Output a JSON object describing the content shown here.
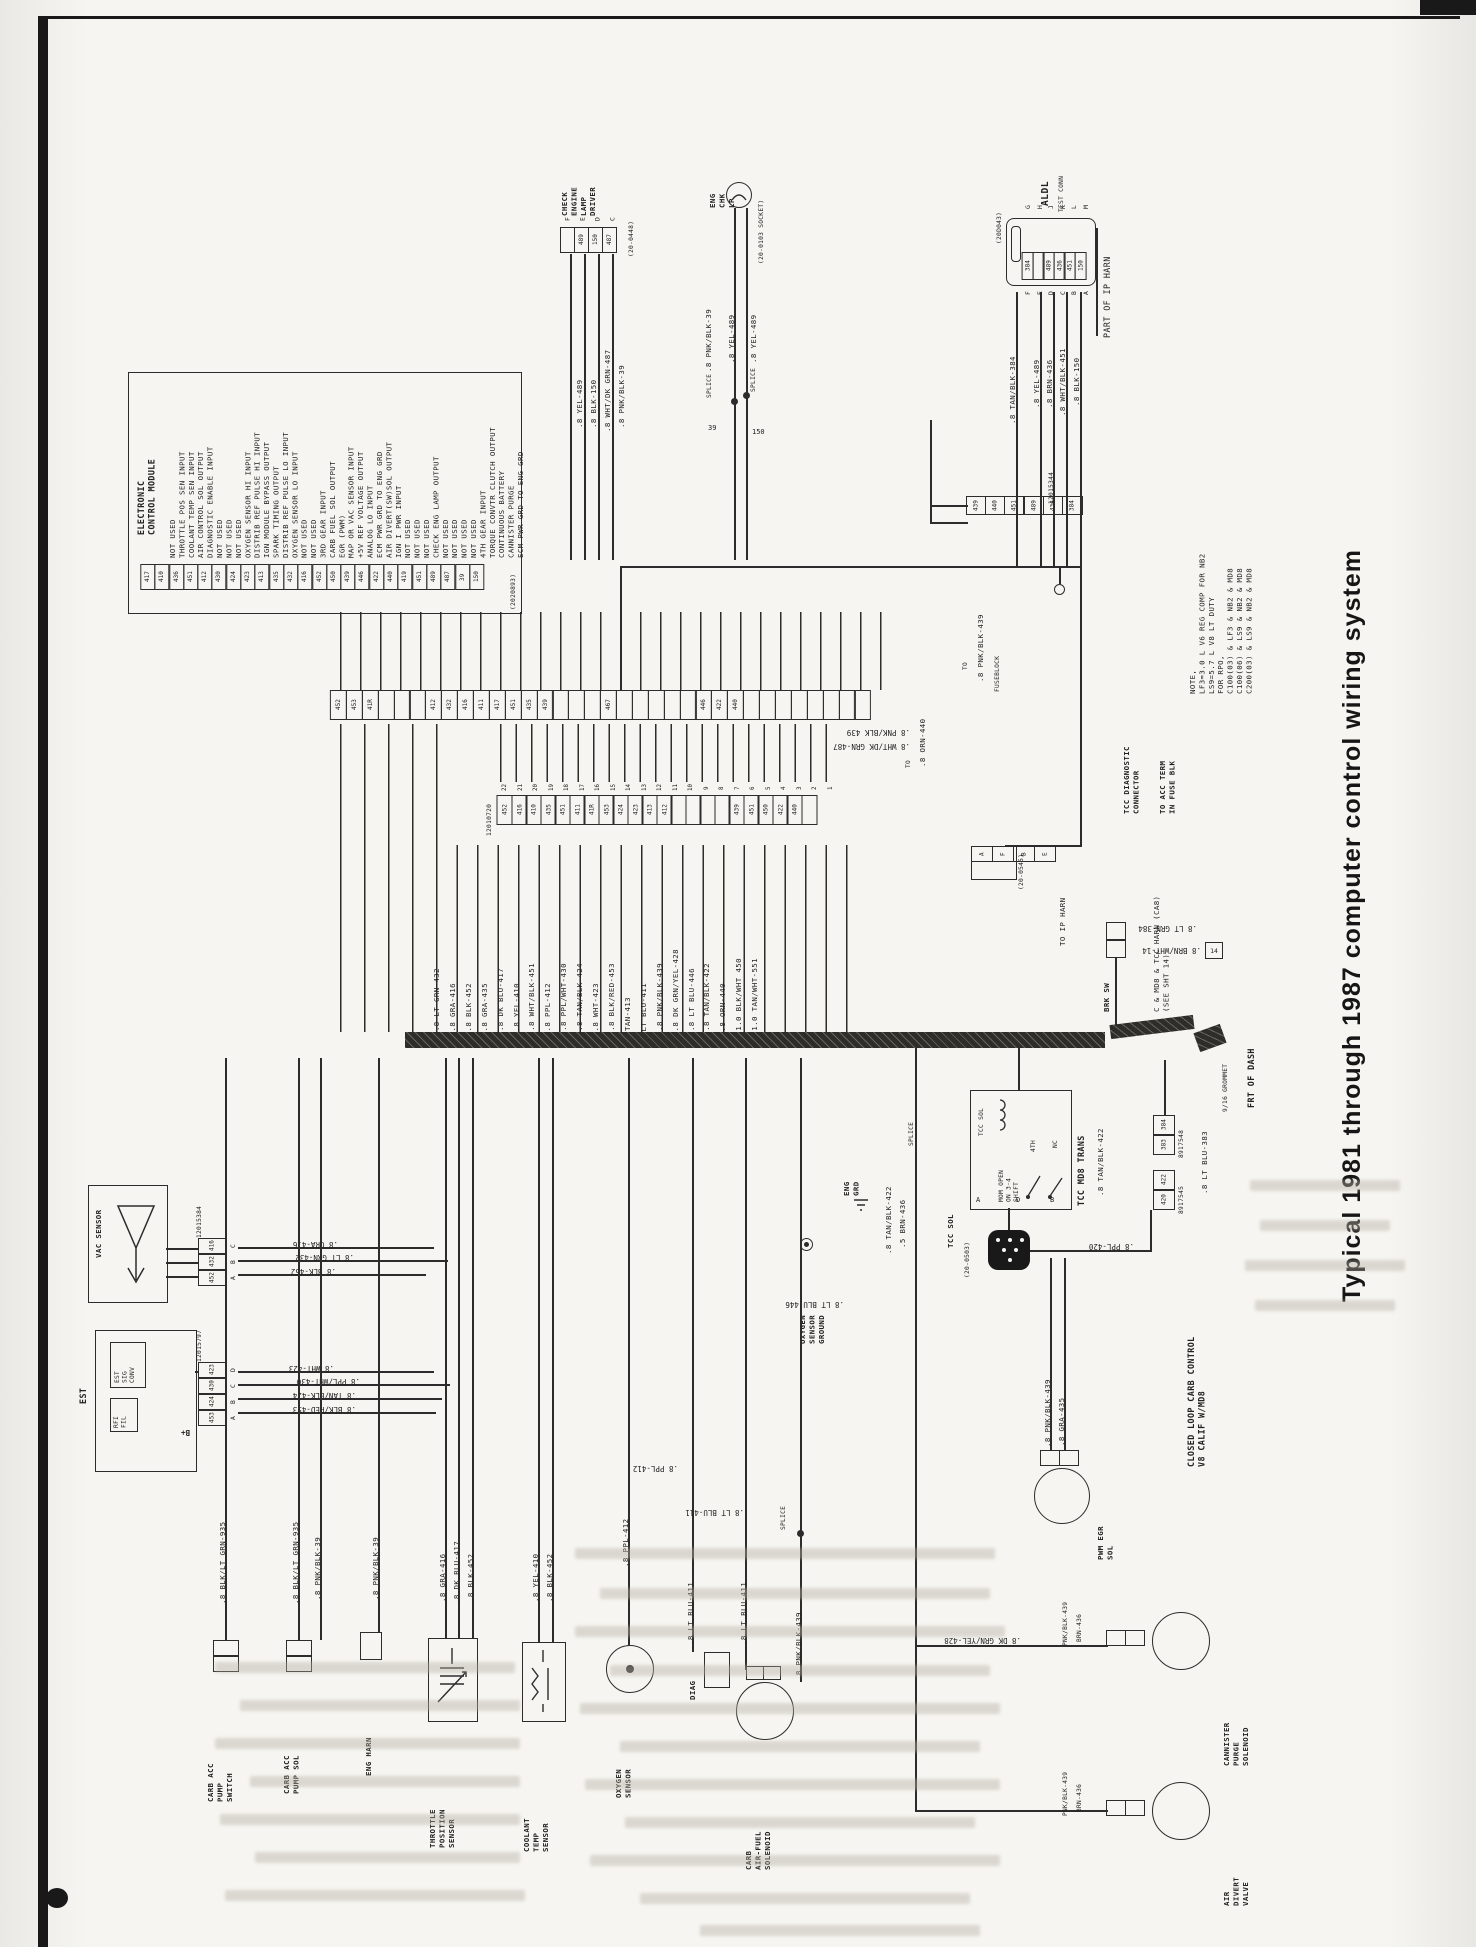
{
  "page": {
    "title": "Typical 1981 through 1987 computer control wiring system"
  },
  "ecm": {
    "id": "(2020893)",
    "title": "ELECTRONIC\nCONTROL MODULE",
    "pins": [
      "NOT USED",
      "THROTTLE POS SEN INPUT",
      "COOLANT TEMP SEN INPUT",
      "AIR CONTROL SOL OUTPUT",
      "DIAGNOSTIC ENABLE INPUT",
      "NOT USED",
      "NOT USED",
      "NOT USED",
      "OXYGEN SENSOR HI INPUT",
      "DISTRIB REF PULSE HI INPUT",
      "IGN MODULE BYPASS OUTPUT",
      "SPARK TIMING OUTPUT",
      "DISTRIB REF PULSE LO INPUT",
      "OXYGEN SENSOR LO INPUT",
      "NOT USED",
      "NOT USED",
      "3RD GEAR INPUT",
      "CARB FUEL SOL OUTPUT",
      "EGR (PWM)",
      "MAP OR VAC SENSOR INPUT",
      "+5V REF VOLTAGE OUTPUT",
      "ANALOG LO INPUT",
      "ECM PWR GRD TO ENG GRD",
      "AIR DIVERT(SW)SOL OUTPUT",
      "IGN I PWR INPUT",
      "NOT USED",
      "NOT USED",
      "NOT USED",
      "CHECK ENG LAMP OUTPUT",
      "NOT USED",
      "NOT USED",
      "NOT USED",
      "NOT USED",
      "4TH GEAR INPUT",
      "TORQUE CONVTR CLUTCH OUTPUT",
      "CONTINUOUS BATTERY",
      "CANNISTER PURGE",
      "ECM PWR GRD TO ENG GRD"
    ],
    "strip": [
      "417",
      "410",
      "436",
      "451",
      "412",
      "430",
      "424",
      "423",
      "413",
      "435",
      "432",
      "416",
      "452",
      "450",
      "439",
      "446",
      "422",
      "440",
      "419",
      "451",
      "489",
      "487",
      "39",
      "150"
    ]
  },
  "driver": {
    "label": "CHECK\nENGINE\nLAMP\nDRIVER",
    "id": "(20-0448)",
    "pins": [
      "F",
      "E",
      "D",
      "C"
    ],
    "cells": [
      "",
      "489",
      "150",
      "487"
    ],
    "w1": ".8 YEL-489",
    "w2": ".8 BLK-150",
    "w3": ".8 WHT/DK GRN-487",
    "w4": ".8 PNK/BLK-39"
  },
  "lamp": {
    "label": "ENG\nCHK\nLP",
    "socket": "(20-0103 SOCKET)",
    "w1": ".8 PNK/BLK-39",
    "w2": ".8 YEL-489",
    "w3": ".8 YEL-489",
    "splice": "SPLICE",
    "n39": "39",
    "n150": "150"
  },
  "aldl": {
    "label": "ALDL",
    "sub": "TEST CONN",
    "id": "(20D043)",
    "top": [
      "G",
      "H",
      "J",
      "K",
      "L",
      "M"
    ],
    "bottom": [
      "F",
      "E",
      "D",
      "C",
      "B",
      "A"
    ],
    "cells": [
      "384",
      "",
      "489",
      "436",
      "451",
      "150"
    ],
    "w1": ".8 TAN/BLK-384",
    "w2": ".8 YEL-489",
    "w3": ".8 BRN-436",
    "w4": ".8 WHT/BLK-451",
    "w5": ".8 BLK-150",
    "part": "PART OF IP HARN"
  },
  "c344": {
    "id": "12015344",
    "cells": [
      "439",
      "440",
      "451",
      "",
      "489",
      "436",
      "384",
      ""
    ],
    "to": "TO",
    "fuseblock": "FUSEBLOCK",
    "w439": ".8 PNK/BLK-439",
    "w440": ".8 ORN-440"
  },
  "note": {
    "text": "NOTE,\nLF3=3.0 L V6 REG COMP FOR NB2\nLS9=5.7 L V8 LT DUTY\nFOR RPO,\nC100(03) & LF3 & NB2 & MD8\nC100(06) & LS9 & NB2 & MD8\nC200(03) & LS9 & NB2 & MD8"
  },
  "mid": {
    "stripA": [
      "452",
      "453",
      "41R",
      "",
      "",
      "",
      "412",
      "432",
      "416",
      "411",
      "417",
      "451",
      "435",
      "439",
      "",
      "",
      "",
      "467",
      "",
      "",
      "",
      "",
      "",
      "446",
      "422",
      "440",
      "",
      "",
      "",
      "",
      "",
      "",
      "",
      ""
    ],
    "c720_id": "12010720",
    "c720_pins": [
      "22",
      "21",
      "20",
      "19",
      "18",
      "17",
      "16",
      "15",
      "14",
      "13",
      "12",
      "11",
      "10",
      "9",
      "8",
      "7",
      "6",
      "5",
      "4",
      "3",
      "2",
      "1"
    ],
    "c720_cells": [
      "452",
      "416",
      "410",
      "435",
      "451",
      "411",
      "41R",
      "453",
      "424",
      "423",
      "413",
      "412",
      "",
      "",
      "",
      "",
      "439",
      "451",
      "450",
      "422",
      "440",
      ""
    ],
    "w487": ".8 WHT/DK GRN-487",
    "w439": ".8 PNK/BLK 439",
    "bundle": [
      ".8 LT GRN-432",
      ".8 GRA-416",
      ".8 BLK-452",
      ".8 GRA-435",
      ".8 DK BLU-417",
      ".8 YEL-410",
      ".8 WHT/BLK-451",
      ".8 PPL-412",
      ".8 PPL/WHT-430",
      ".8 TAN/BLK-424",
      ".8 WHT-423",
      ".8 BLK/RED-453",
      "TAN-413",
      "LT BLU-411",
      ".8 PNK/BLK-439",
      ".8 DK GRN/YEL-428",
      ".8 LT BLU-446",
      ".8 TAN/BLK-422",
      ".8 ORN-440",
      "1.0 BLK/WHT 450",
      "1.0 TAN/WHT-551"
    ],
    "c545_id": "(20-0545)",
    "c545_cells": [
      "A",
      "F",
      "B",
      "E"
    ],
    "tcc_diag": "TCC DIAGNOSTIC\nCONNECTOR",
    "to_acc": "TO ACC TERM\nIN FUSE BLK",
    "w384": ".8 LT GRN-384",
    "w14": ".8 BRN/WHT-14",
    "b14": "14",
    "cmd8": "C & MD8 & TCC HARN (CA8)\n(SEE SHT 14)",
    "to_ip": "TO IP HARN",
    "brk": "BRK SW",
    "band_label": "FRT OF DASH",
    "grommet": "9/16 GROMMET"
  },
  "tcc": {
    "box": "TCC MD8 TRANS",
    "sol_in": "TCC SOL",
    "mom": "MOM OPEN\nON 3-4\nSHIFT",
    "p4": "4TH",
    "nc": "NC",
    "pa": "A",
    "pd": "D",
    "pb": "B",
    "c0503": "(20-0503)",
    "sol": "TCC SOL",
    "w420": ".8 PPL-420",
    "w422": ".8 TAN/BLK-422",
    "c48_id": "8917548",
    "c48": [
      "384",
      "383"
    ],
    "c45_id": "8917545",
    "c45": [
      "422",
      "420"
    ],
    "w383": ".8 LT BLU-383",
    "w422b": ".8 TAN/BLK-422",
    "w436": ".5 BRN-436",
    "eng_grd": "ENG\nGRD",
    "oxy": "OXYGEN\nSENSOR\nGROUND",
    "w446": ".8 LT BLU-446",
    "splice": "SPLICE"
  },
  "left": {
    "vac": "VAC SENSOR",
    "c384_id": "12015384",
    "c384_cells": [
      "416",
      "432",
      "452"
    ],
    "c384_pins": [
      "C",
      "B",
      "A"
    ],
    "w416": ".8 GRA-416",
    "w432": ".8 LT GRN-432",
    "w452": ".8 BLK-452",
    "est": "EST",
    "inner1": "EST\nSIG\nCONV",
    "inner2": "RFI\nFIL",
    "bplus": "B+",
    "c797_id": "12015797",
    "c797_cells": [
      "423",
      "430",
      "424",
      "453"
    ],
    "c797_pins": [
      "D",
      "C",
      "B",
      "A"
    ],
    "w423": ".8 WHT-423",
    "w430": ".8 PPL/WHT-430",
    "w424": ".8 TAN/BLK-424",
    "w453": ".8 BLK/RED-453"
  },
  "bottom": {
    "w935": ".8 BLK/LT GRN-935",
    "w39": ".8 PNK/BLK-39",
    "sw": "CARB ACC\nPUMP\nSWITCH",
    "sol": "CARB ACC\nPUMP SOL",
    "harn": "ENG HARN",
    "w416": ".8 GRA-416",
    "w417": ".8 DK BLU-417",
    "w452": ".8 BLK-452",
    "tps": "THROTTLE\nPOSITION\nSENSOR",
    "w410": ".8 YEL-410",
    "cts": "COOLANT\nTEMP\nSENSOR",
    "w412": ".8 PPL-412",
    "o2": "OXYGEN\nSENSOR",
    "w411": ".8 LT BLU-411",
    "diag": "DIAG",
    "w439": ".8 PNK/BLK-439",
    "afs": "CARB\nAIR-FUEL\nSOLENOID",
    "splice": "SPLICE"
  },
  "right": {
    "loop": "CLOSED LOOP CARB CONTROL\nV8 CALIF W/MD8",
    "w439": ".8 PNK/BLK-439",
    "w435": ".8 GRA-435",
    "egr": "PWM EGR\nSOL",
    "w428": ".8 DK GRN/YEL-428",
    "wp439": "PNK/BLK-439",
    "wb436": "BRN-436",
    "cann": "CANNISTER\nPURGE\nSOLENOID",
    "divert": "AIR\nDIVERT\nVALVE"
  }
}
